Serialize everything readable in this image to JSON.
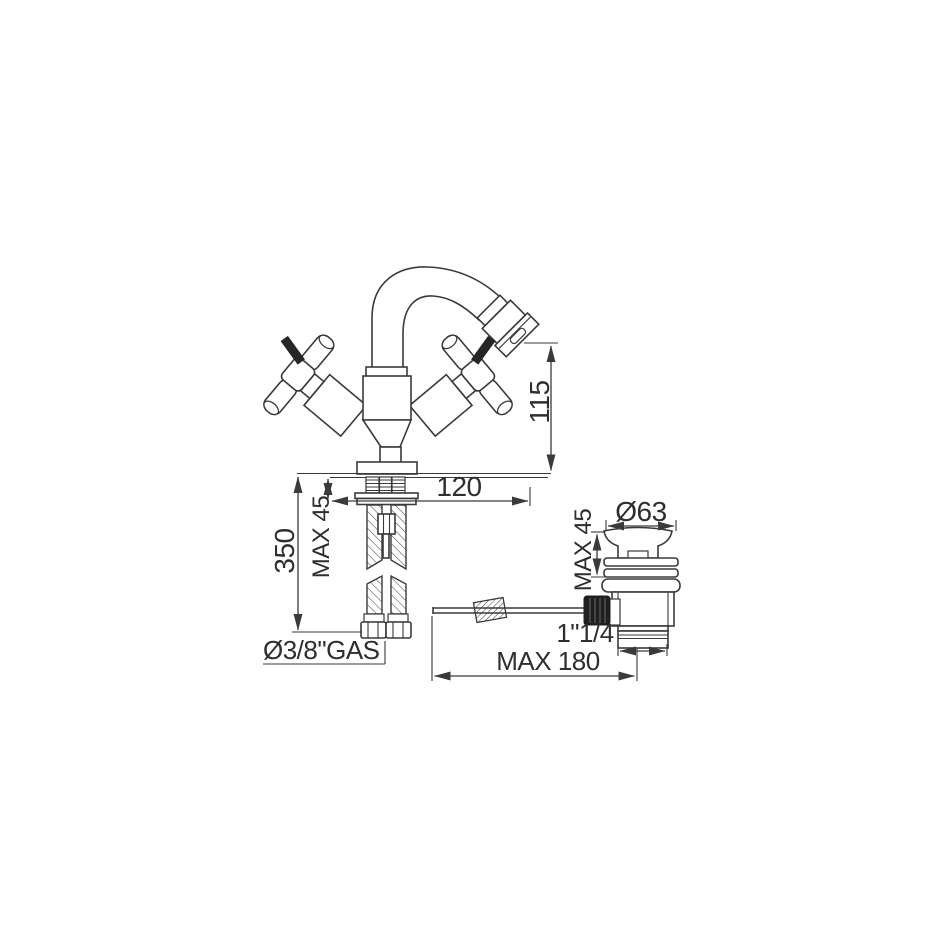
{
  "page": {
    "background": "#ffffff",
    "line_color": "#3a3a3a",
    "text_color": "#2e2e2e"
  },
  "drawing": {
    "title": "Bidet mixer with pop-up waste - dimensional technical drawing",
    "labels": {
      "spout_height": "115",
      "spout_projection": "120",
      "hose_length": "350",
      "max_deck_faucet": "MAX 45",
      "hose_thread": "Ø3/8\"GAS",
      "waste_cap_diameter": "Ø63",
      "max_deck_waste": "MAX 45",
      "waste_outlet_thread": "1\"1/4",
      "rod_reach": "MAX 180"
    }
  }
}
